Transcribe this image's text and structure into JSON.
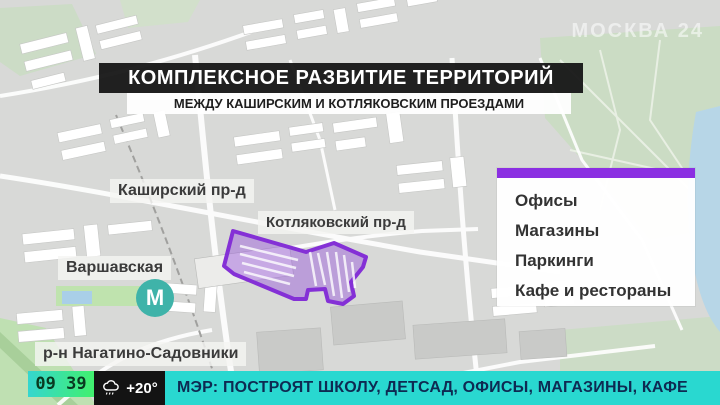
{
  "watermark": {
    "text": "МОСКВА 24"
  },
  "banner": {
    "title": "КОМПЛЕКСНОЕ РАЗВИТИЕ ТЕРРИТОРИЙ",
    "subtitle": "МЕЖДУ КАШИРСКИМ И КОТЛЯКОВСКИМ ПРОЕЗДАМИ"
  },
  "map": {
    "labels": {
      "kashirsky": "Каширский пр-д",
      "kotlyakovsky": "Котляковский пр-д",
      "varshavskaya": "Варшавская",
      "district": "р-н Нагатино-Садовники"
    },
    "metro_letter": "М"
  },
  "info_panel": {
    "items": [
      "Офисы",
      "Магазины",
      "Паркинги",
      "Кафе и рестораны"
    ]
  },
  "ticker": {
    "time": "09 39",
    "temperature": "+20°",
    "weather_icon": "rain-cloud-icon",
    "headline": "МЭР: ПОСТРОЯТ ШКОЛУ, ДЕТСАД, ОФИСЫ, МАГАЗИНЫ, КАФЕ"
  },
  "colors": {
    "accent_purple": "#8b2fe2",
    "zone_purple_stroke": "#8430d6",
    "zone_purple_fill": "rgba(147,77,219,0.42)",
    "metro_teal": "#3fb3a9",
    "ticker_cyan": "#29d8d0",
    "clock_gradient_start": "#35d6cf",
    "clock_gradient_end": "#41f06e"
  }
}
